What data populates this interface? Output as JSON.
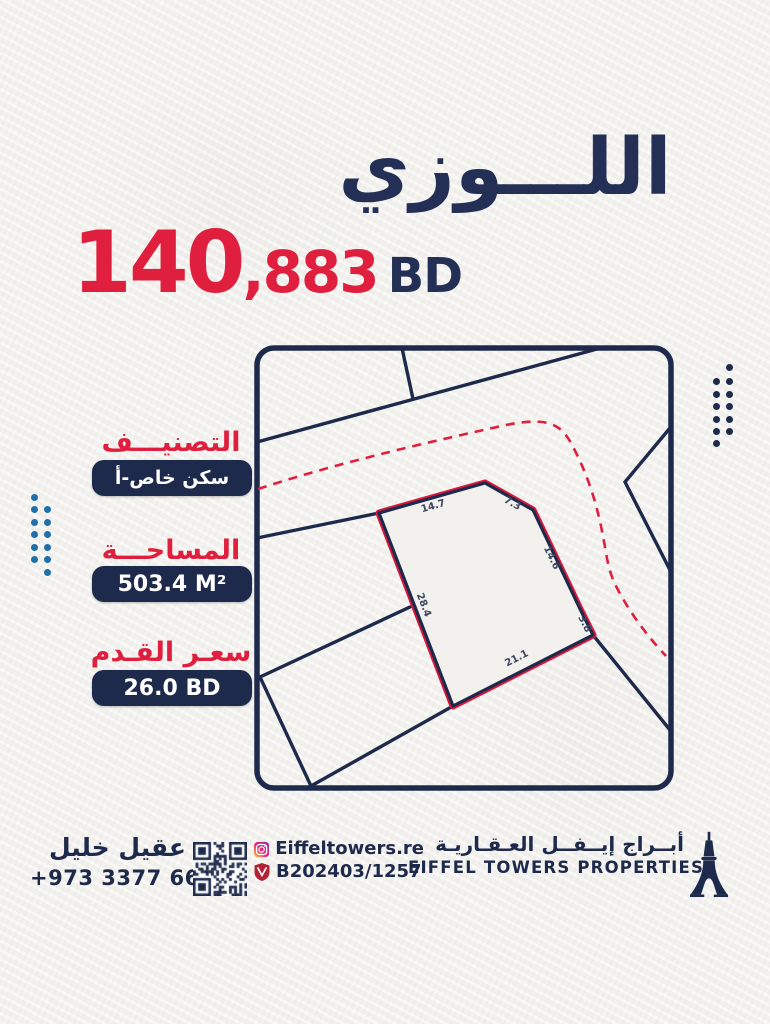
{
  "title": "اللـــوزي",
  "price": {
    "main": "140",
    "rest": ",883",
    "currency": "BD"
  },
  "specs": [
    {
      "label": "التصنيـــف",
      "value": "سكن خاص-أ"
    },
    {
      "label": "المساحـــة",
      "value": "503.4 M²"
    },
    {
      "label": "سعـر القـدم",
      "value": "26.0 BD"
    }
  ],
  "map": {
    "parcel_dimensions": {
      "top_left": "14.7",
      "top_right": "7.3",
      "right_upper": "14.6",
      "right_lower": "3.8",
      "bottom": "21.1",
      "left": "28.4"
    }
  },
  "footer": {
    "agent_name": "عقيل خليل",
    "agent_phone": "+973 3377 6624",
    "instagram_handle": "Eiffeltowers.re",
    "license_number": "B202403/1257",
    "company_name_ar": "أبــراج إيــفــل العـقـاريـة",
    "company_name_en": "EIFFEL TOWERS PROPERTIES"
  },
  "colors": {
    "navy": "#232f55",
    "navy_deep": "#1e2a4b",
    "red": "#e01f3e",
    "blue_dots": "#1f6fa8",
    "paper": "#f2f1ee"
  }
}
